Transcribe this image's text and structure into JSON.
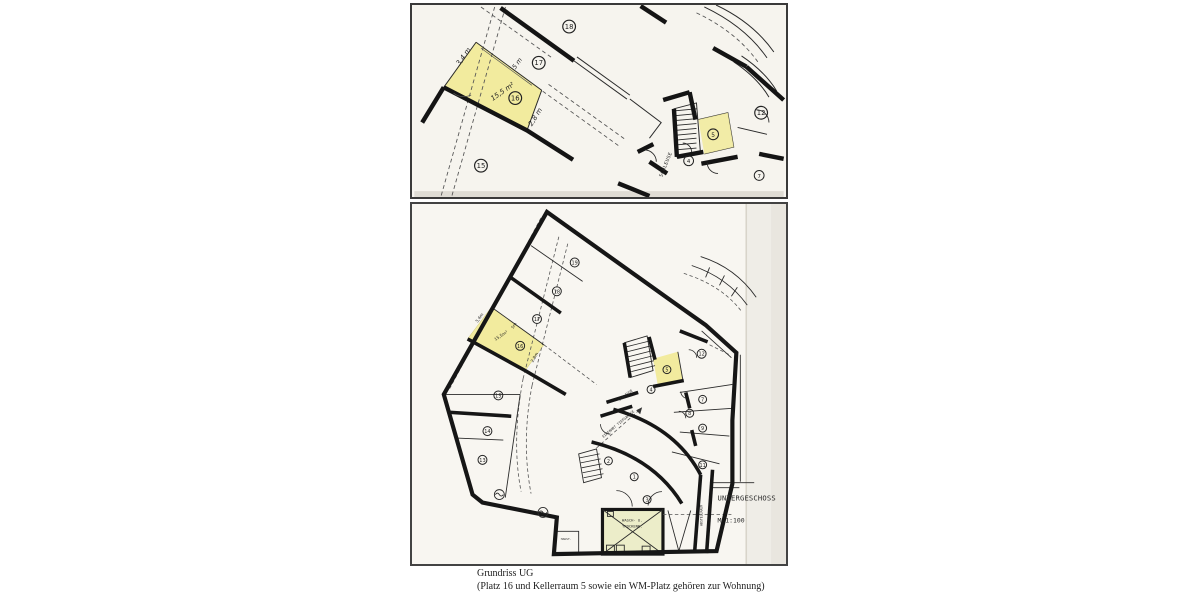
{
  "document": {
    "type": "scanned basement floor plan (Tiefgarage / Untergeschoss)",
    "highlight_color": "#f2eb9e",
    "washroom_highlight_color": "#ecedc9",
    "paper_color": "#f7f5ef"
  },
  "caption": {
    "line1": "Grundriss UG",
    "line2": "(Platz 16 und Kellerraum 5 sowie ein WM-Platz gehören zur Wohnung)"
  },
  "plan_top": {
    "labels": {
      "p18": "18",
      "p17": "17",
      "p16": "16",
      "p15": "15",
      "r12": "12",
      "r5": "5",
      "r4": "4",
      "r7": "7"
    },
    "annotations": {
      "a1": "3,4 m",
      "a2": "5 m",
      "a3": "15,5 m²",
      "a4": "2,8 m"
    },
    "texts": {
      "schleuse": "SCHLEUSE"
    }
  },
  "plan_bottom": {
    "labels": {
      "p19": "19",
      "p18": "18",
      "p17": "17",
      "p16": "16",
      "p15": "15",
      "p14": "14",
      "p13": "13",
      "r12": "12",
      "r11": "11",
      "r9": "9",
      "r8": "8",
      "r7": "7",
      "r5": "5",
      "r4": "4",
      "r3": "3",
      "r2": "2",
      "r1": "1"
    },
    "annotations": {
      "a1": "3,4m",
      "a2": "5m",
      "a3": "15,5m²",
      "a4": "2,8m"
    },
    "texts": {
      "schleuse": "SCHLEUSE",
      "einfahrt": "EINFAHRT TIEFGARAGE",
      "wasch1": "WASCH- U.",
      "wasch2": "TROCKENR.",
      "haust": "HAUST.",
      "abstell": "ABSTELLRAUM",
      "floor": "UNTERGESCHOSS",
      "scale": "M 1:100"
    }
  }
}
